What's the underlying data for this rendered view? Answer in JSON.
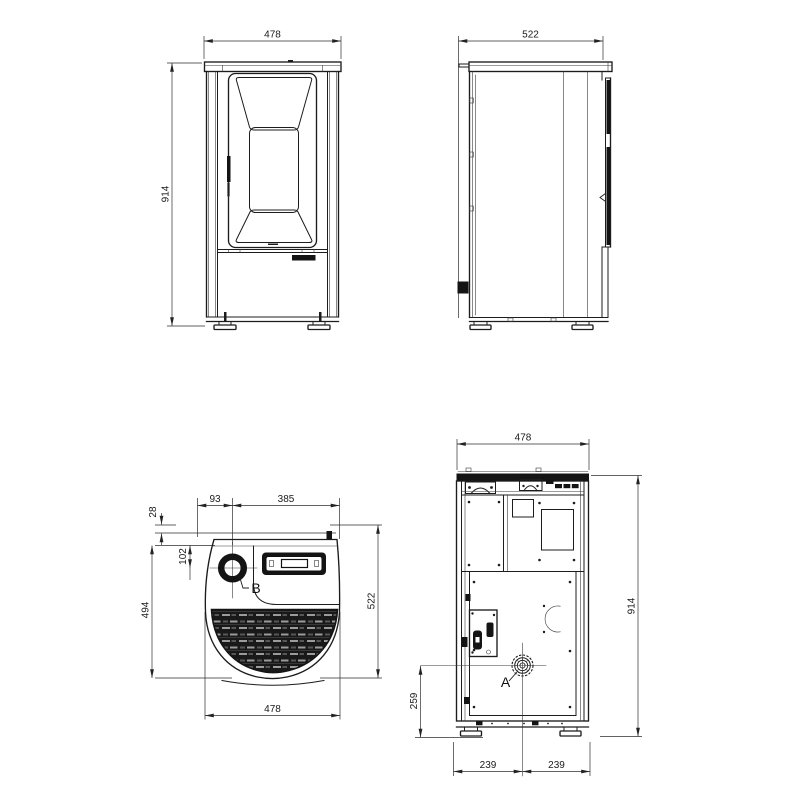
{
  "page": {
    "background": "#ffffff",
    "line_color": "#1c1c1c",
    "kind": "pellet-stove-dimension-drawing"
  },
  "drawing": {
    "front_view": {
      "width_mm": "478",
      "height_mm": "914"
    },
    "side_view": {
      "depth_mm": "522"
    },
    "top_view": {
      "flue_offset_left_mm": "93",
      "top_remainder_mm": "385",
      "rear_clearance_mm": "28",
      "flue_offset_rear_mm": "102",
      "body_depth_mm": "494",
      "total_depth_mm": "522",
      "width_mm": "478",
      "flue_label": "B"
    },
    "rear_view": {
      "width_mm": "478",
      "height_mm": "914",
      "flue_center_height_mm": "259",
      "flue_offset_left_mm": "239",
      "flue_offset_right_mm": "239",
      "flue_label": "A"
    }
  }
}
